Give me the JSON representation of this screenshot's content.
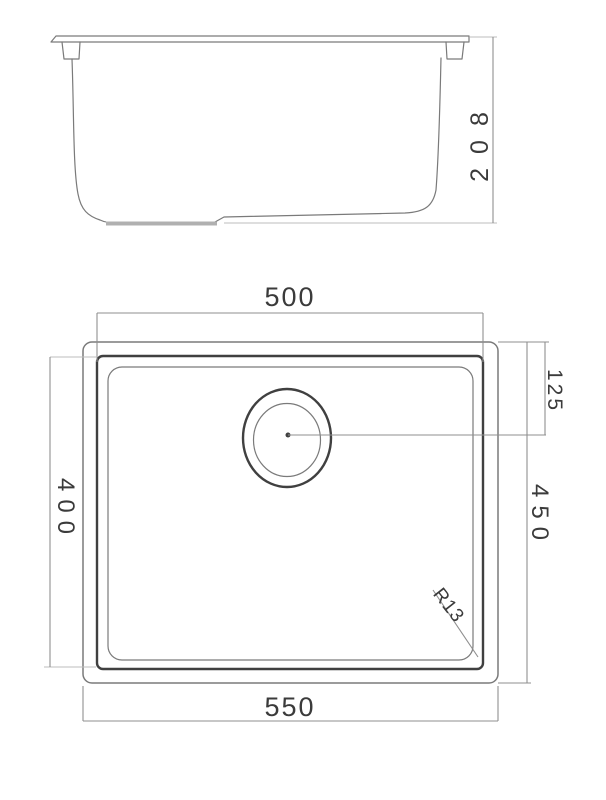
{
  "drawing": {
    "colors": {
      "background": "#ffffff",
      "stroke_light": "#bcbcbc",
      "stroke_medium": "#7a7a7a",
      "stroke_dark": "#3f3f3f",
      "dim_stroke": "#8f8f8f",
      "pad_stroke": "#b0b0b0",
      "text_color": "#3a3a3a"
    },
    "side_view": {
      "height_dim": "208"
    },
    "plan_view": {
      "bowl_width_dim": "500",
      "overall_width_dim": "550",
      "bowl_depth_dim": "400",
      "overall_depth_dim": "450",
      "drain_offset_dim": "125",
      "corner_radius_dim": "R13"
    }
  }
}
